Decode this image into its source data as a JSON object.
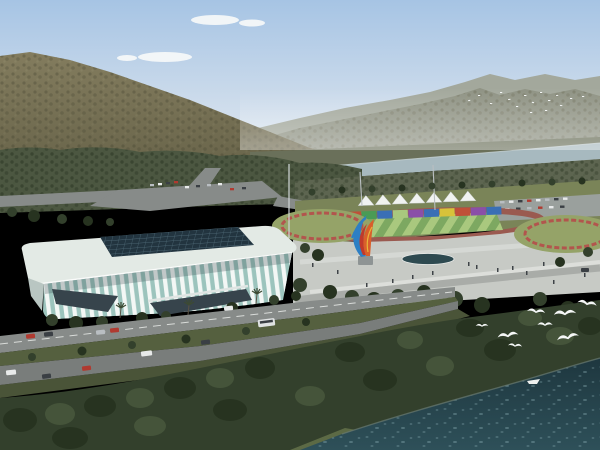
{
  "scene": {
    "description": "aerial architectural rendering of a white ribbed sports arena beside a river, with outdoor track field, colorful sculpture plaza, wooded mountains and flying gulls",
    "tent_count": 7,
    "foreground_gull_count": 8,
    "distant_flock_count": 16
  },
  "palette": {
    "sky_top": "#a6c4e4",
    "sky_bottom": "#e6ebf0",
    "cloud": "#f6f8f9",
    "far_ridge": "#8f9384",
    "far_ridge_light": "#a3a89c",
    "far_bank": "#6a705a",
    "mountain": "#837c5e",
    "mountain_dark": "#5c5a42",
    "mountain_light": "#9a9473",
    "valley_trees": "#4c5741",
    "bank_trees": "#5d6550",
    "river": "#a7b9bf",
    "river_sheen": "#c6d2d4",
    "lawn": "#7a8458",
    "parking": "#9aa09d",
    "infield_light": "#a9c87e",
    "infield_dark": "#7da861",
    "track": "#9a5a50",
    "tent": "#f0f2f0",
    "mast": "#b9bfc2",
    "stand_red": "#c05038",
    "stand_green": "#4a9b55",
    "stand_blue": "#3a6fb5",
    "stand_purple": "#8a4fa8",
    "stand_yellow": "#d8c23a",
    "garden_green": "#95a368",
    "garden_ring": "#b2554d",
    "pole": "#cfd4d6",
    "plaza": "#c7cac5",
    "plaza_path": "#dcdeda",
    "plaza_road": "#a9aca8",
    "pool": "#2e4a50",
    "person": "#3e4347",
    "arena_roof": "#e3eae5",
    "arena_skylight": "#22343f",
    "skylight_grid": "#4c6673",
    "facade_glass": "#9cc4bd",
    "facade_rib": "#f3f7f5",
    "facade_shadow": "#b9c6c2",
    "entrance_dark": "#37444c",
    "road": "#878b89",
    "road_dark": "#797d7b",
    "road_line": "#e8eae8",
    "median": "#55603f",
    "verge": "#4a5438",
    "grass": "#5c6a45",
    "tree_dark": "#273320",
    "tree_mid": "#33402c",
    "tree_light": "#45543a",
    "water_deep": "#1e373f",
    "water_light": "#2e5059",
    "sparkle": "#9fc3c9",
    "shore": "#6a7a72",
    "bird": "#f5f7f7",
    "sculpture_blue": "#2d7fc4",
    "sculpture_orange": "#d95f2b",
    "sculpture_red": "#c03a2b",
    "sculpture_yellow": "#e8b73a",
    "car_red": "#b03a30",
    "car_white": "#e8eaea",
    "car_dark": "#3a3f44",
    "car_silver": "#b9bec2",
    "bus_white": "#dfe2e2"
  }
}
